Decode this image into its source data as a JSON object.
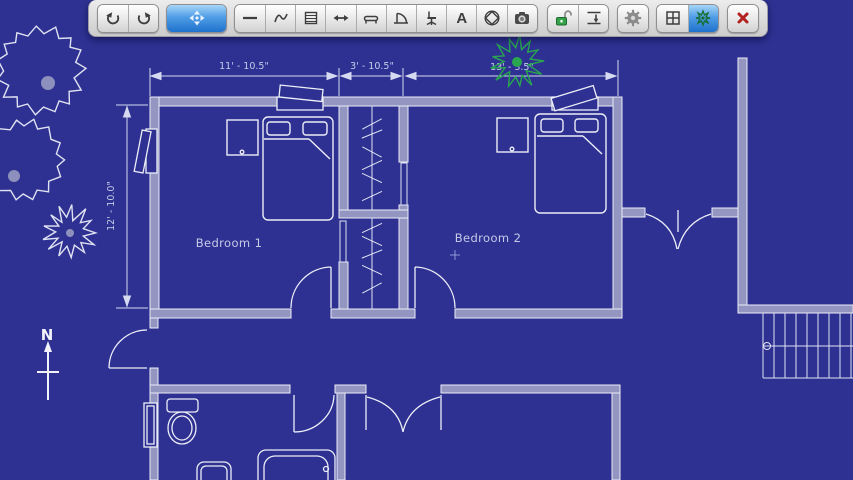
{
  "toolbar": {
    "items": [
      {
        "name": "undo",
        "icon": "undo-arrow-icon",
        "selected": false
      },
      {
        "name": "redo",
        "icon": "redo-arrow-icon",
        "selected": false
      },
      {
        "name": "move-tool",
        "icon": "move-arrows-icon",
        "selected": true
      },
      {
        "name": "wall-line-tool",
        "icon": "line-icon",
        "selected": false
      },
      {
        "name": "freehand-tool",
        "icon": "squiggle-icon",
        "selected": false
      },
      {
        "name": "lined-panel-tool",
        "icon": "lined-panel-icon",
        "selected": false
      },
      {
        "name": "measure-tool",
        "icon": "horizontal-arrow-icon",
        "selected": false
      },
      {
        "name": "window-furniture-tool",
        "icon": "window-sill-icon",
        "selected": false
      },
      {
        "name": "door-tool",
        "icon": "door-swing-icon",
        "selected": false
      },
      {
        "name": "chair-tool",
        "icon": "office-chair-icon",
        "selected": false
      },
      {
        "name": "text-tool",
        "icon": "letter-a-icon",
        "selected": false,
        "glyph": "A"
      },
      {
        "name": "shape-tool",
        "icon": "diamond-circle-icon",
        "selected": false
      },
      {
        "name": "camera-tool",
        "icon": "camera-icon",
        "selected": false
      },
      {
        "name": "lock-toggle",
        "icon": "unlocked-padlock-icon",
        "selected": false
      },
      {
        "name": "snap-dimension-tool",
        "icon": "dimension-snap-icon",
        "selected": false
      },
      {
        "name": "settings",
        "icon": "gear-icon",
        "selected": false
      },
      {
        "name": "grid-toggle",
        "icon": "grid-icon",
        "selected": false
      },
      {
        "name": "plant-tool",
        "icon": "tree-icon",
        "selected": true
      },
      {
        "name": "close",
        "icon": "close-x-icon",
        "selected": false
      }
    ]
  },
  "plan": {
    "rooms": [
      {
        "label": "Bedroom 1"
      },
      {
        "label": "Bedroom 2"
      }
    ],
    "dimensions": {
      "top_left": "11' - 10.5\"",
      "top_mid": "3' - 10.5\"",
      "top_right": "13' - 3.5\"",
      "left_side": "12' - 10.0\""
    },
    "compass_label": "N",
    "colors": {
      "background": "#2e3191",
      "wall_fill": "#9496c2",
      "line_white": "#eceef8",
      "label_text": "#c6cbe8",
      "tree_green": "#28a74e",
      "tree_white": "#dfe2f2",
      "tree_dot": "#8d90bd"
    },
    "trees": [
      {
        "cx": 40,
        "cy": 70,
        "r": 46,
        "n": 30,
        "jag": 0.18,
        "color": "#dfe2f2",
        "dx": 8,
        "dy": 13,
        "dotR": 7,
        "dotFill": "#8d90bd"
      },
      {
        "cx": 24,
        "cy": 160,
        "r": 42,
        "n": 28,
        "jag": 0.18,
        "color": "#dfe2f2",
        "dx": -10,
        "dy": 16,
        "dotR": 6,
        "dotFill": "#8d90bd"
      },
      {
        "cx": 69,
        "cy": 232,
        "r": 29,
        "n": 26,
        "jag": 0.45,
        "color": "#dfe2f2",
        "dx": 1,
        "dy": 1,
        "dotR": 4,
        "dotFill": "#8d90bd"
      },
      {
        "cx": 517,
        "cy": 62,
        "r": 28,
        "n": 26,
        "jag": 0.45,
        "color": "#28a74e",
        "dx": 0,
        "dy": 0,
        "dotR": 5,
        "dotFill": "#28a74e"
      }
    ]
  }
}
